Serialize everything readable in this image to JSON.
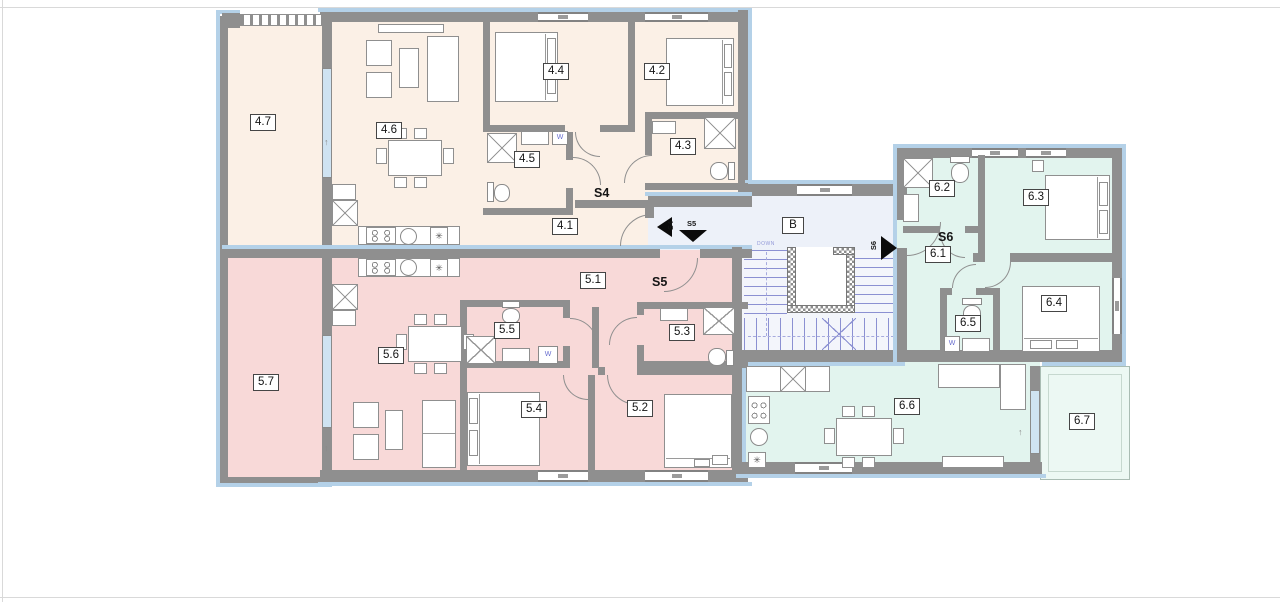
{
  "drawing": {
    "type": "architectural floor plan, three apartments around a stairwell",
    "units": {
      "s4": "S4",
      "s5": "S5",
      "s6": "S6"
    },
    "rooms": {
      "r41": "4.1",
      "r42": "4.2",
      "r43": "4.3",
      "r44": "4.4",
      "r45": "4.5",
      "r46": "4.6",
      "r47": "4.7",
      "r51": "5.1",
      "r52": "5.2",
      "r53": "5.3",
      "r54": "5.4",
      "r55": "5.5",
      "r56": "5.6",
      "r57": "5.7",
      "r61": "6.1",
      "r62": "6.2",
      "r63": "6.3",
      "r64": "6.4",
      "r65": "6.5",
      "r66": "6.6",
      "r67": "6.7",
      "corridor": "B"
    },
    "stairs": {
      "down_label": "DOWN"
    },
    "nav_arrows": {
      "left": "S4",
      "down": "S5",
      "right": "S6"
    },
    "marks": {
      "washer": "W",
      "threshold": "↑",
      "appliance": "✳"
    },
    "colors": {
      "s4_fill": "#fbf0e6",
      "s5_fill": "#f8d9d8",
      "s6_fill": "#e2f4ee",
      "balcony_fill": "#ecf8f3",
      "corridor_fill": "#edf1f9",
      "stair_fill": "#f3f5fb",
      "wall": "#8f8f8f",
      "exterior_band": "#b4d1e8",
      "stair_tread": "#8b90d2",
      "glazing": "#cfe3f2"
    }
  }
}
